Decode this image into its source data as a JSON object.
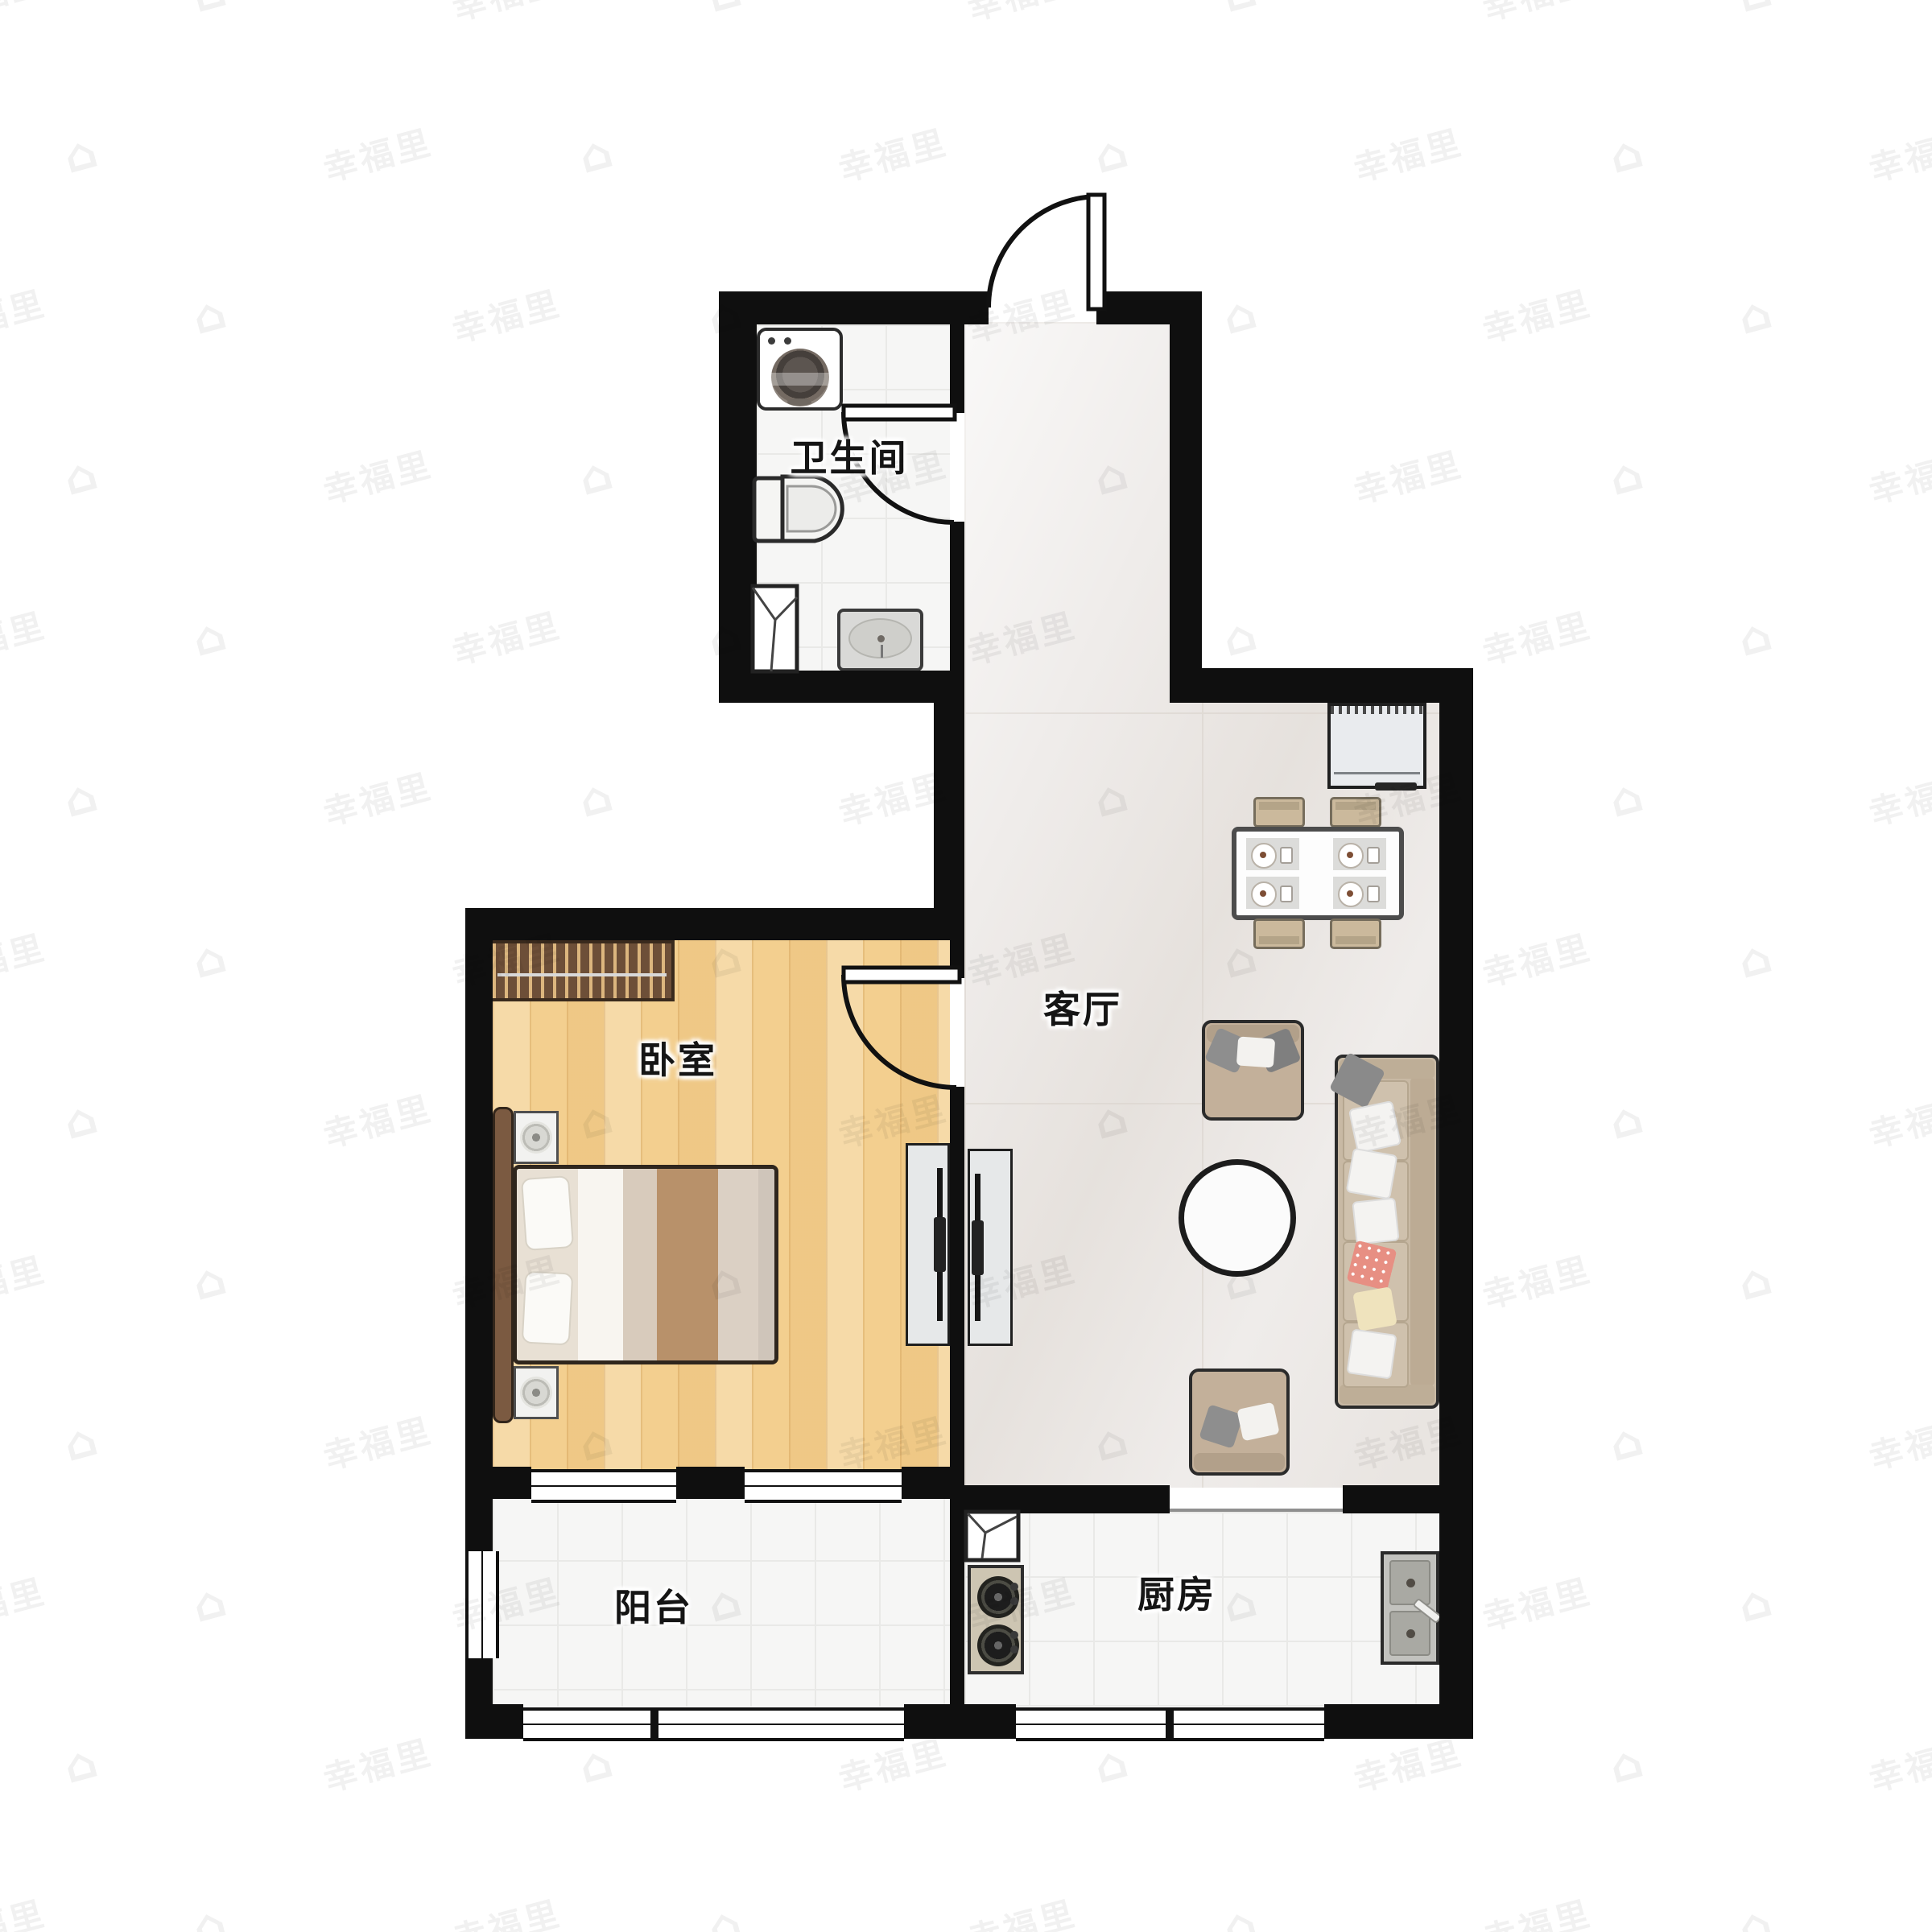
{
  "plan": {
    "type": "apartment-floor-plan",
    "rooms": [
      {
        "id": "bathroom",
        "label": "卫生间"
      },
      {
        "id": "living-room",
        "label": "客厅"
      },
      {
        "id": "bedroom",
        "label": "卧室"
      },
      {
        "id": "balcony",
        "label": "阳台"
      },
      {
        "id": "kitchen",
        "label": "厨房"
      }
    ],
    "furniture": [
      "washing-machine",
      "toilet",
      "shower-corner",
      "bathroom-sink",
      "fridge-cabinet",
      "dining-table",
      "dining-chairs",
      "armchair",
      "armchair",
      "coffee-table",
      "sofa",
      "tv-unit",
      "tv-unit",
      "wardrobe",
      "double-bed",
      "nightstand",
      "nightstand",
      "flue-box",
      "gas-stove",
      "kitchen-sink"
    ]
  },
  "watermark": {
    "text": "幸福里",
    "icon_glyph": "⌂",
    "rows": 13,
    "cols": 9,
    "opacity": 0.05
  },
  "colors": {
    "wall": "#0f0f0f",
    "bedroom_floor": "#f3cf8f",
    "living_floor": "#efecea",
    "tile_floor": "#f6f6f5",
    "sofa": "#c8b9a4",
    "wardrobe": "#6d4f38",
    "pillow_pink": "#e78f83",
    "pillow_cream": "#efe3bd"
  }
}
